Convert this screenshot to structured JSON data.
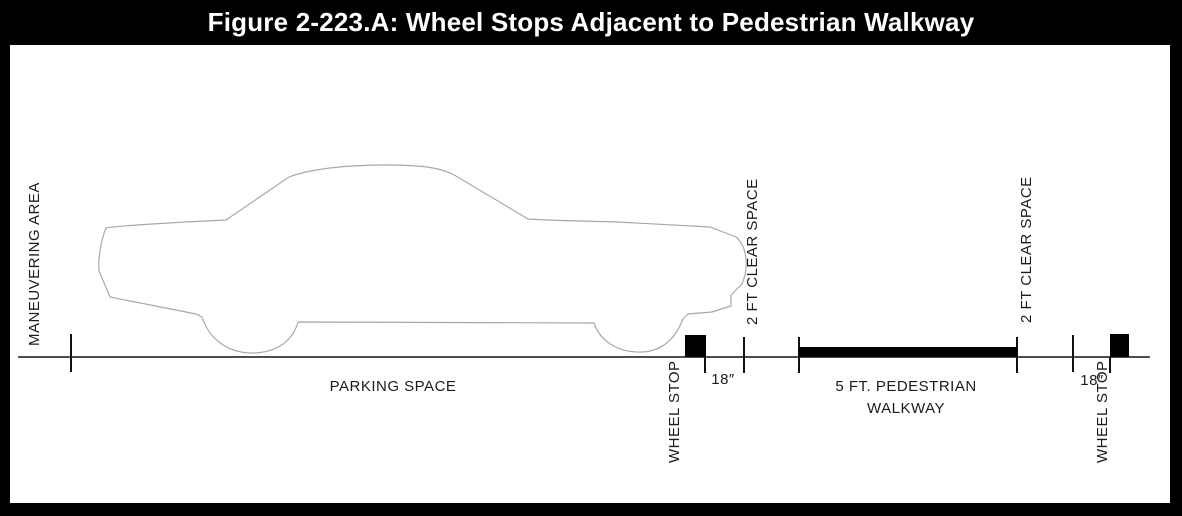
{
  "title": "Figure 2-223.A: Wheel Stops Adjacent to Pedestrian Walkway",
  "diagram": {
    "maneuvering_area_label": "MANEUVERING AREA",
    "parking_space_label": "PARKING SPACE",
    "left_wheel_stop": {
      "label": "WHEEL STOP",
      "offset_dim": "18″"
    },
    "right_wheel_stop": {
      "label": "WHEEL STOP",
      "offset_dim": "18″"
    },
    "left_clear_space_label": "2 FT CLEAR SPACE",
    "right_clear_space_label": "2 FT CLEAR SPACE",
    "walkway_label_line1": "5 FT. PEDESTRIAN",
    "walkway_label_line2": "WALKWAY",
    "car_icon": "sedan-side-profile-outline"
  },
  "colors": {
    "frame": "#000000",
    "title_text": "#ffffff",
    "background": "#ffffff",
    "ground_line": "#4d4d4d",
    "car_outline": "#a9a9a9",
    "solid_black_elements": "#000000",
    "label_text": "#1c1c1c"
  }
}
